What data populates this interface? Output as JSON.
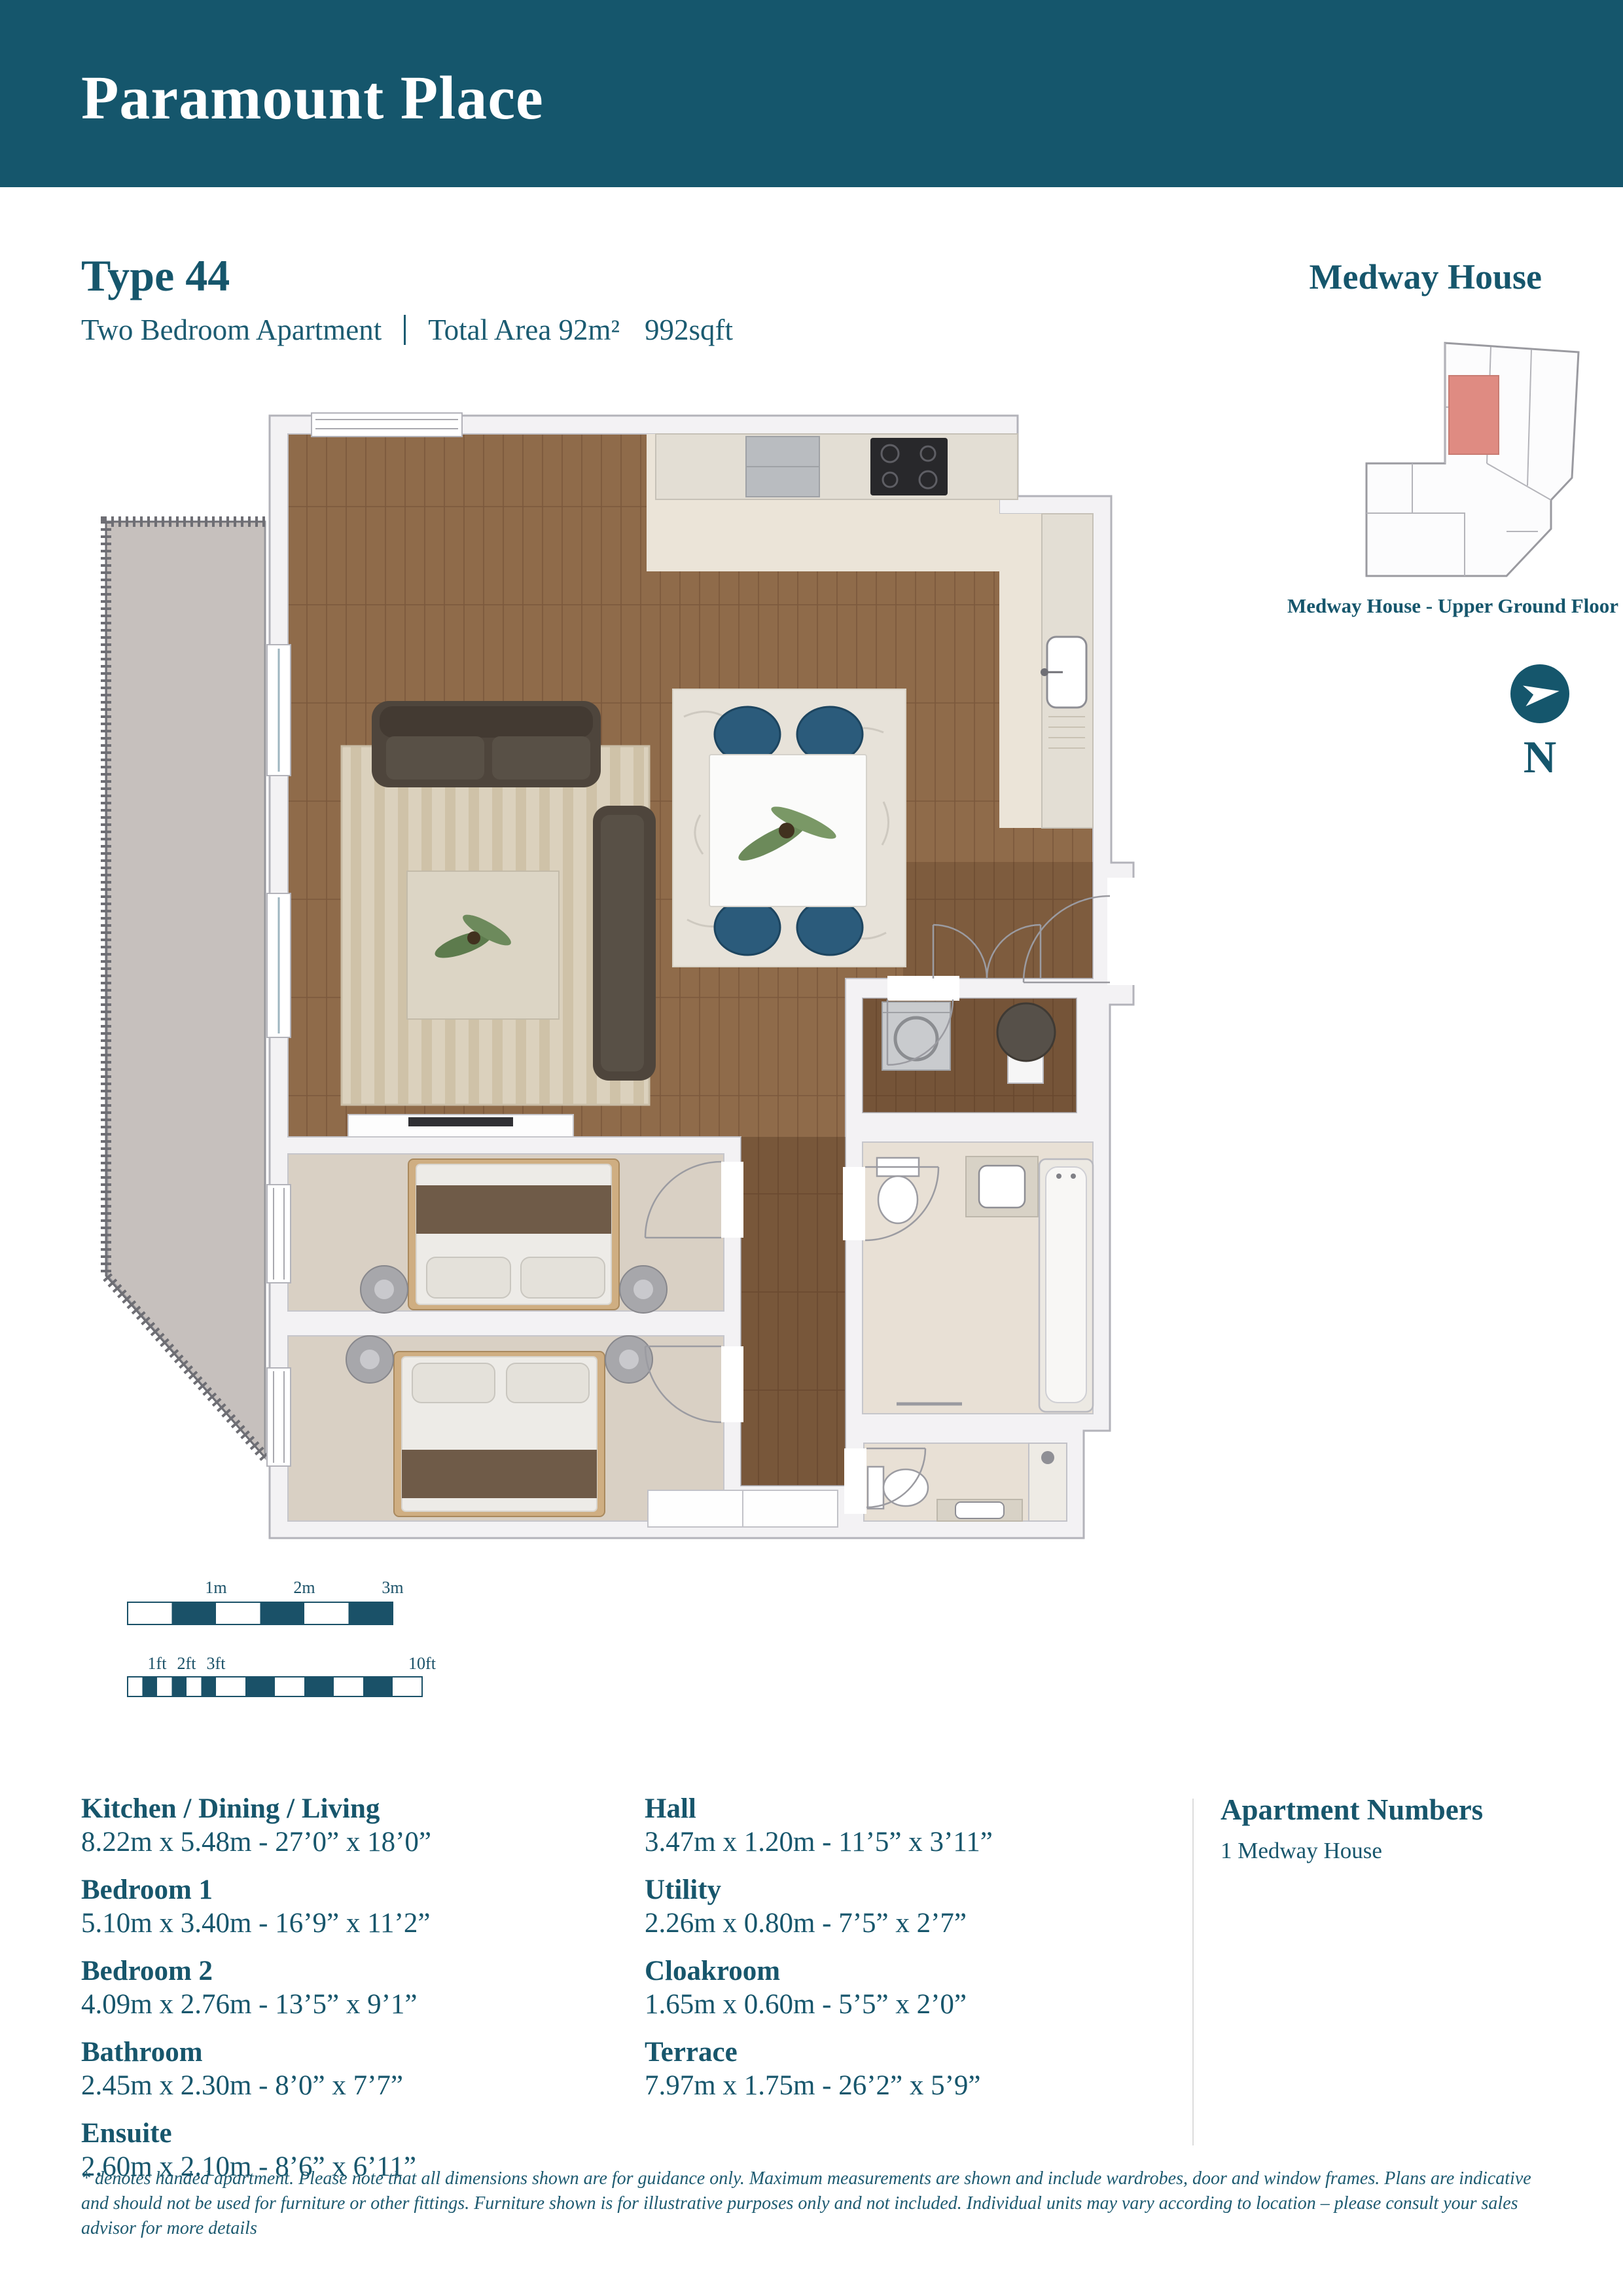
{
  "header": {
    "title": "Paramount Place",
    "bg_color": "#15566C"
  },
  "unit": {
    "type_label": "Type 44",
    "apartment_type": "Two Bedroom Apartment",
    "total_area": "Total Area 92m²",
    "sqft": "992sqft"
  },
  "building": {
    "name": "Medway House",
    "floor_caption": "Medway House - Upper Ground Floor",
    "highlight_color": "#DF8B82"
  },
  "north": {
    "label": "N"
  },
  "scale": {
    "m_labels": [
      "1m",
      "2m",
      "3m"
    ],
    "ft_labels": [
      "1ft",
      "2ft",
      "3ft",
      "10ft"
    ],
    "bar_color": "#1A5168"
  },
  "rooms_left": [
    {
      "name": "Kitchen / Dining / Living",
      "dims": "8.22m x 5.48m  -  27’0” x 18’0”"
    },
    {
      "name": "Bedroom 1",
      "dims": "5.10m x 3.40m  -  16’9” x 11’2”"
    },
    {
      "name": "Bedroom 2",
      "dims": "4.09m x 2.76m  -  13’5” x 9’1”"
    },
    {
      "name": "Bathroom",
      "dims": "2.45m x 2.30m  -  8’0” x 7’7”"
    },
    {
      "name": "Ensuite",
      "dims": "2.60m x 2.10m  -  8’6” x 6’11”"
    }
  ],
  "rooms_middle": [
    {
      "name": "Hall",
      "dims": "3.47m x 1.20m  -  11’5” x 3’11”"
    },
    {
      "name": "Utility",
      "dims": "2.26m x 0.80m  -  7’5” x 2’7”"
    },
    {
      "name": "Cloakroom",
      "dims": "1.65m x 0.60m  -  5’5” x 2’0”"
    },
    {
      "name": "Terrace",
      "dims": "7.97m x 1.75m  -  26’2” x 5’9”"
    }
  ],
  "apartments": {
    "heading": "Apartment Numbers",
    "item": "1 Medway House"
  },
  "disclaimer": "* denotes handed apartment. Please note that all dimensions shown are for guidance only. Maximum measurements are shown and include wardrobes, door and window frames. Plans are indicative and should not be used for furniture or other fittings. Furniture shown is for illustrative purposes only and not included. Individual units may vary according to location – please consult your sales advisor for more details"
}
